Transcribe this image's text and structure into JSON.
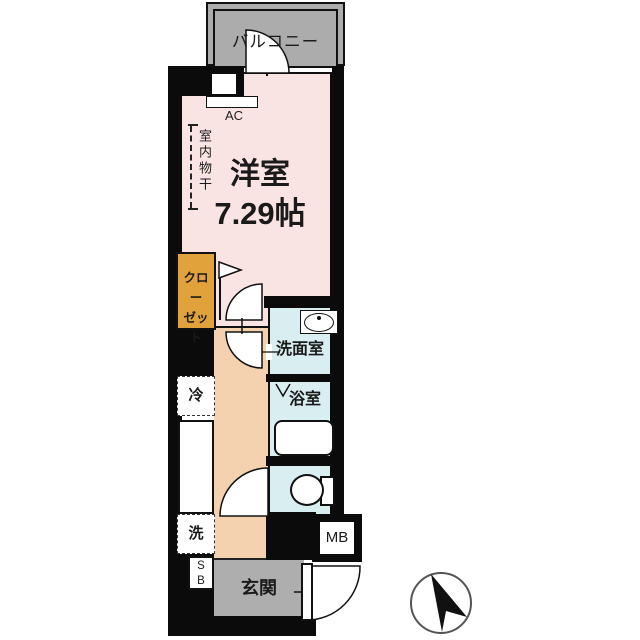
{
  "floor_plan": {
    "balcony": {
      "label": "バルコニー"
    },
    "main_room": {
      "label": "洋室",
      "size": "7.29帖"
    },
    "ac": {
      "label": "AC"
    },
    "indoor_drying": {
      "label": "室内物干"
    },
    "closet": {
      "line1": "クロー",
      "line2": "ゼット"
    },
    "washroom": {
      "label": "洗面室"
    },
    "bathroom": {
      "label": "浴室"
    },
    "refrigerator": {
      "label": "冷"
    },
    "washer": {
      "label": "洗"
    },
    "meter_box": {
      "label": "MB"
    },
    "shoe_box": {
      "line1": "S",
      "line2": "B"
    },
    "entrance": {
      "label": "玄関"
    },
    "colors": {
      "wall": "#0b0b0b",
      "room_pink": "#f9e4e3",
      "corridor_beige": "#f5d2af",
      "closet_orange": "#e2a23b",
      "wet_area_blue": "#d9eef1",
      "gray_area": "#aeaeae",
      "balcony_gray": "#acacac"
    },
    "symbols": {
      "compass": "north-arrow",
      "doors": "swing-arc",
      "fridge_mark": "dashed-box-x",
      "washer_mark": "dashed-box-x"
    }
  }
}
